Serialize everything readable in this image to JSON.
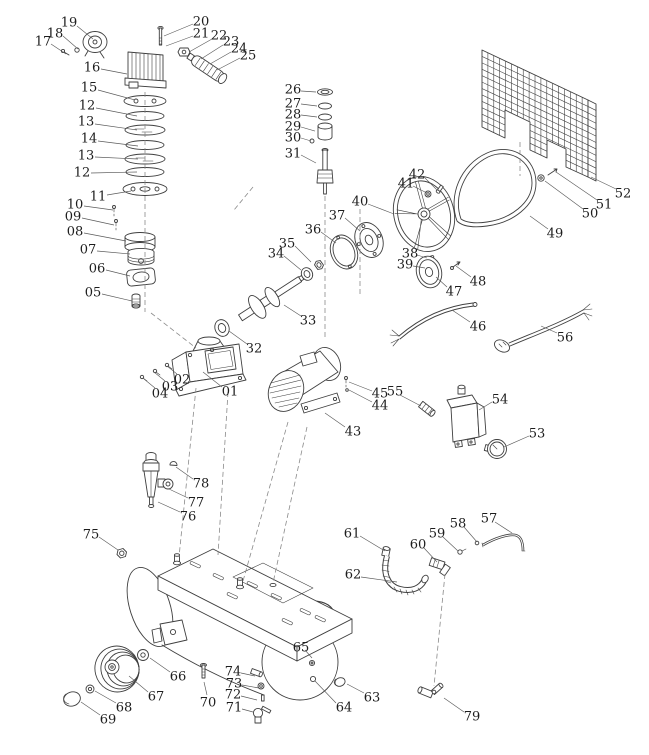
{
  "figure": {
    "colors": {
      "background": "#ffffff",
      "line": "#3f3f3f",
      "leader": "#5a5a5a",
      "label": "#1d1d1d"
    },
    "labels": [
      {
        "t": "17",
        "x": 43,
        "y": 41,
        "l": [
          51,
          44,
          66,
          54
        ]
      },
      {
        "t": "18",
        "x": 55,
        "y": 33,
        "l": [
          63,
          36,
          78,
          49
        ]
      },
      {
        "t": "19",
        "x": 69,
        "y": 22,
        "l": [
          77,
          26,
          93,
          39
        ]
      },
      {
        "t": "20",
        "x": 201,
        "y": 21,
        "l": [
          193,
          24,
          164,
          36
        ]
      },
      {
        "t": "21",
        "x": 201,
        "y": 33,
        "l": [
          193,
          36,
          166,
          46
        ]
      },
      {
        "t": "22",
        "x": 219,
        "y": 35,
        "l": [
          212,
          39,
          189,
          52
        ]
      },
      {
        "t": "23",
        "x": 231,
        "y": 41,
        "l": [
          223,
          45,
          201,
          59
        ]
      },
      {
        "t": "24",
        "x": 239,
        "y": 48,
        "l": [
          231,
          52,
          210,
          64
        ]
      },
      {
        "t": "25",
        "x": 248,
        "y": 55,
        "l": [
          240,
          58,
          217,
          70
        ]
      },
      {
        "t": "16",
        "x": 92,
        "y": 67,
        "l": [
          101,
          69,
          127,
          74
        ]
      },
      {
        "t": "15",
        "x": 89,
        "y": 87,
        "l": [
          98,
          90,
          135,
          100
        ]
      },
      {
        "t": "12",
        "x": 87,
        "y": 105,
        "l": [
          96,
          108,
          137,
          116
        ]
      },
      {
        "t": "13",
        "x": 86,
        "y": 121,
        "l": [
          95,
          124,
          137,
          130
        ]
      },
      {
        "t": "14",
        "x": 89,
        "y": 138,
        "l": [
          98,
          141,
          138,
          146
        ]
      },
      {
        "t": "13",
        "x": 86,
        "y": 155,
        "l": [
          95,
          157,
          138,
          159
        ]
      },
      {
        "t": "12",
        "x": 82,
        "y": 172,
        "l": [
          91,
          173,
          137,
          172
        ]
      },
      {
        "t": "11",
        "x": 98,
        "y": 196,
        "l": [
          107,
          195,
          131,
          191
        ]
      },
      {
        "t": "10",
        "x": 75,
        "y": 204,
        "l": [
          84,
          206,
          113,
          210
        ]
      },
      {
        "t": "09",
        "x": 73,
        "y": 216,
        "l": [
          82,
          218,
          114,
          225
        ]
      },
      {
        "t": "08",
        "x": 75,
        "y": 231,
        "l": [
          84,
          233,
          126,
          241
        ]
      },
      {
        "t": "07",
        "x": 88,
        "y": 249,
        "l": [
          97,
          251,
          130,
          254
        ]
      },
      {
        "t": "06",
        "x": 97,
        "y": 268,
        "l": [
          106,
          270,
          130,
          276
        ]
      },
      {
        "t": "05",
        "x": 93,
        "y": 292,
        "l": [
          102,
          294,
          132,
          301
        ]
      },
      {
        "t": "04",
        "x": 160,
        "y": 393,
        "l": [
          155,
          388,
          144,
          379
        ]
      },
      {
        "t": "03",
        "x": 170,
        "y": 386,
        "l": [
          165,
          381,
          154,
          372
        ]
      },
      {
        "t": "02",
        "x": 182,
        "y": 379,
        "l": [
          177,
          374,
          167,
          366
        ]
      },
      {
        "t": "01",
        "x": 230,
        "y": 391,
        "l": [
          222,
          387,
          203,
          372
        ]
      },
      {
        "t": "32",
        "x": 254,
        "y": 348,
        "l": [
          247,
          344,
          229,
          331
        ]
      },
      {
        "t": "26",
        "x": 293,
        "y": 89,
        "l": [
          301,
          91,
          316,
          92
        ]
      },
      {
        "t": "27",
        "x": 293,
        "y": 103,
        "l": [
          301,
          104,
          317,
          106
        ]
      },
      {
        "t": "28",
        "x": 293,
        "y": 114,
        "l": [
          301,
          115,
          317,
          117
        ]
      },
      {
        "t": "29",
        "x": 293,
        "y": 126,
        "l": [
          301,
          127,
          315,
          131
        ]
      },
      {
        "t": "30",
        "x": 293,
        "y": 137,
        "l": [
          301,
          138,
          311,
          141
        ]
      },
      {
        "t": "31",
        "x": 293,
        "y": 153,
        "l": [
          301,
          155,
          316,
          163
        ]
      },
      {
        "t": "34",
        "x": 276,
        "y": 253,
        "l": [
          284,
          256,
          301,
          270
        ]
      },
      {
        "t": "35",
        "x": 287,
        "y": 243,
        "l": [
          295,
          246,
          311,
          262
        ]
      },
      {
        "t": "36",
        "x": 313,
        "y": 229,
        "l": [
          321,
          232,
          336,
          243
        ]
      },
      {
        "t": "37",
        "x": 337,
        "y": 215,
        "l": [
          345,
          218,
          360,
          231
        ]
      },
      {
        "t": "40",
        "x": 360,
        "y": 201,
        "l": [
          368,
          204,
          394,
          214
        ]
      },
      {
        "t": "41",
        "x": 406,
        "y": 183,
        "l": [
          413,
          186,
          427,
          193
        ]
      },
      {
        "t": "42",
        "x": 417,
        "y": 174,
        "l": [
          424,
          177,
          437,
          190
        ]
      },
      {
        "t": "38",
        "x": 410,
        "y": 253,
        "l": [
          417,
          255,
          427,
          258
        ]
      },
      {
        "t": "39",
        "x": 405,
        "y": 264,
        "l": [
          413,
          266,
          425,
          268
        ]
      },
      {
        "t": "33",
        "x": 308,
        "y": 320,
        "l": [
          301,
          316,
          284,
          305
        ]
      },
      {
        "t": "43",
        "x": 353,
        "y": 431,
        "l": [
          345,
          427,
          325,
          413
        ]
      },
      {
        "t": "44",
        "x": 380,
        "y": 405,
        "l": [
          372,
          402,
          349,
          390
        ]
      },
      {
        "t": "45",
        "x": 380,
        "y": 393,
        "l": [
          372,
          391,
          349,
          382
        ]
      },
      {
        "t": "55",
        "x": 395,
        "y": 391,
        "l": [
          400,
          395,
          421,
          406
        ]
      },
      {
        "t": "54",
        "x": 500,
        "y": 399,
        "l": [
          492,
          402,
          479,
          410
        ]
      },
      {
        "t": "53",
        "x": 537,
        "y": 433,
        "l": [
          529,
          436,
          504,
          447
        ]
      },
      {
        "t": "46",
        "x": 478,
        "y": 326,
        "l": [
          470,
          322,
          452,
          310
        ]
      },
      {
        "t": "47",
        "x": 454,
        "y": 291,
        "l": [
          447,
          287,
          436,
          277
        ]
      },
      {
        "t": "48",
        "x": 478,
        "y": 281,
        "l": [
          471,
          277,
          456,
          266
        ]
      },
      {
        "t": "49",
        "x": 555,
        "y": 233,
        "l": [
          548,
          229,
          530,
          216
        ]
      },
      {
        "t": "56",
        "x": 565,
        "y": 337,
        "l": [
          557,
          333,
          541,
          326
        ]
      },
      {
        "t": "50",
        "x": 590,
        "y": 213,
        "l": [
          583,
          209,
          545,
          181
        ]
      },
      {
        "t": "51",
        "x": 604,
        "y": 204,
        "l": [
          597,
          200,
          556,
          172
        ]
      },
      {
        "t": "52",
        "x": 623,
        "y": 193,
        "l": [
          616,
          189,
          591,
          177
        ]
      },
      {
        "t": "57",
        "x": 489,
        "y": 518,
        "l": [
          495,
          522,
          512,
          533
        ]
      },
      {
        "t": "58",
        "x": 458,
        "y": 523,
        "l": [
          464,
          527,
          477,
          542
        ]
      },
      {
        "t": "59",
        "x": 437,
        "y": 533,
        "l": [
          443,
          537,
          458,
          551
        ]
      },
      {
        "t": "60",
        "x": 418,
        "y": 544,
        "l": [
          424,
          548,
          437,
          562
        ]
      },
      {
        "t": "61",
        "x": 352,
        "y": 533,
        "l": [
          360,
          536,
          385,
          551
        ]
      },
      {
        "t": "62",
        "x": 353,
        "y": 574,
        "l": [
          361,
          577,
          397,
          582
        ]
      },
      {
        "t": "65",
        "x": 301,
        "y": 647,
        "l": [
          305,
          650,
          312,
          658
        ]
      },
      {
        "t": "66",
        "x": 178,
        "y": 676,
        "l": [
          170,
          672,
          150,
          658
        ]
      },
      {
        "t": "67",
        "x": 156,
        "y": 696,
        "l": [
          148,
          692,
          129,
          676
        ]
      },
      {
        "t": "68",
        "x": 124,
        "y": 707,
        "l": [
          116,
          703,
          95,
          691
        ]
      },
      {
        "t": "69",
        "x": 108,
        "y": 719,
        "l": [
          100,
          715,
          81,
          702
        ]
      },
      {
        "t": "70",
        "x": 208,
        "y": 702,
        "l": [
          207,
          695,
          204,
          682
        ]
      },
      {
        "t": "71",
        "x": 234,
        "y": 707,
        "l": [
          242,
          709,
          253,
          712
        ]
      },
      {
        "t": "72",
        "x": 233,
        "y": 694,
        "l": [
          241,
          696,
          257,
          700
        ]
      },
      {
        "t": "73",
        "x": 234,
        "y": 683,
        "l": [
          242,
          685,
          259,
          688
        ]
      },
      {
        "t": "74",
        "x": 233,
        "y": 671,
        "l": [
          241,
          673,
          255,
          676
        ]
      },
      {
        "t": "75",
        "x": 91,
        "y": 534,
        "l": [
          99,
          537,
          118,
          550
        ]
      },
      {
        "t": "76",
        "x": 188,
        "y": 516,
        "l": [
          180,
          512,
          158,
          502
        ]
      },
      {
        "t": "77",
        "x": 196,
        "y": 502,
        "l": [
          188,
          498,
          169,
          489
        ]
      },
      {
        "t": "78",
        "x": 201,
        "y": 483,
        "l": [
          193,
          479,
          176,
          467
        ]
      },
      {
        "t": "79",
        "x": 472,
        "y": 716,
        "l": [
          464,
          712,
          444,
          698
        ]
      },
      {
        "t": "63",
        "x": 372,
        "y": 697,
        "l": [
          364,
          693,
          347,
          684
        ]
      },
      {
        "t": "64",
        "x": 344,
        "y": 707,
        "l": [
          336,
          703,
          315,
          681
        ]
      }
    ],
    "dashes": [
      [
        145,
        92,
        145,
        312
      ],
      [
        151,
        313,
        196,
        348
      ],
      [
        325,
        196,
        325,
        340
      ],
      [
        360,
        209,
        360,
        294
      ],
      [
        520,
        142,
        520,
        176
      ],
      [
        253,
        187,
        234,
        210
      ],
      [
        196,
        388,
        179,
        557
      ],
      [
        228,
        392,
        218,
        555
      ],
      [
        288,
        422,
        243,
        581
      ],
      [
        307,
        427,
        273,
        583
      ],
      [
        445,
        574,
        434,
        686
      ]
    ]
  }
}
